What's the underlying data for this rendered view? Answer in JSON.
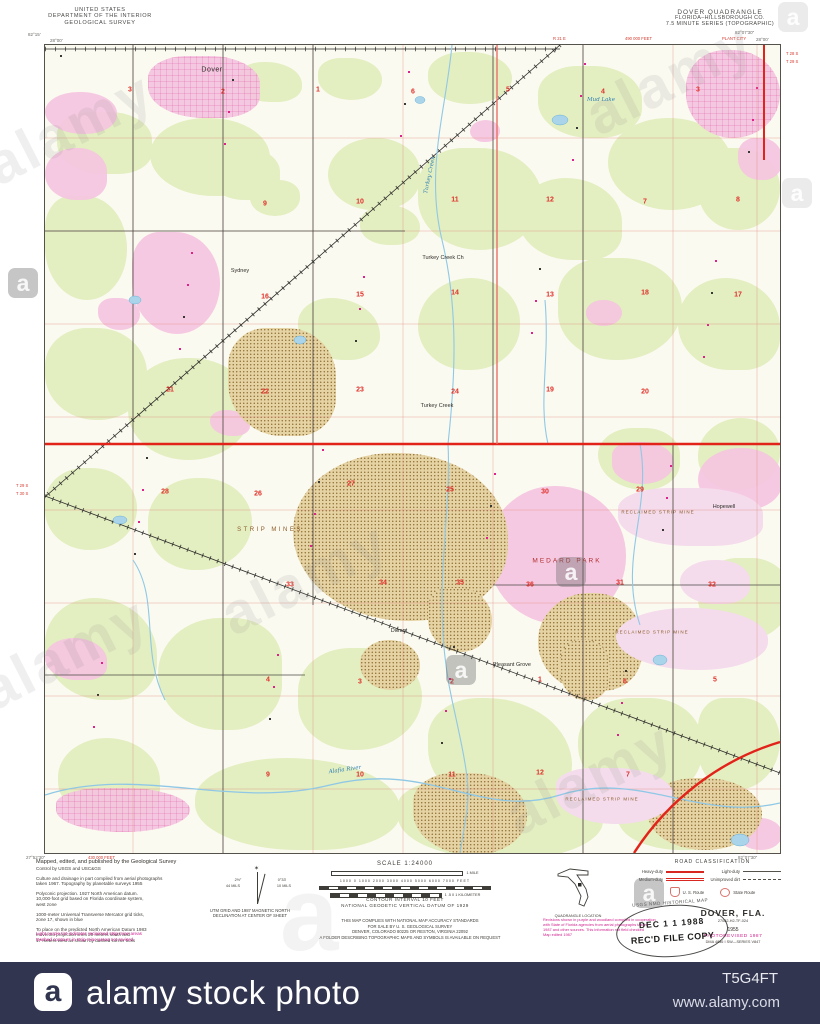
{
  "watermark": {
    "brand": "alamy",
    "letter": "a"
  },
  "footer_bar": {
    "logo_letter": "a",
    "brand": "alamy stock photo",
    "image_id": "T5G4FT",
    "url": "www.alamy.com"
  },
  "header": {
    "left": [
      "UNITED STATES",
      "DEPARTMENT OF THE INTERIOR",
      "GEOLOGICAL SURVEY"
    ],
    "right": [
      "DOVER QUADRANGLE",
      "FLORIDA–HILLSBOROUGH CO.",
      "7.5 MINUTE SERIES (TOPOGRAPHIC)"
    ]
  },
  "map": {
    "corners": {
      "tl_lon": "82°15'",
      "tl_lat": "28°00'",
      "tr_lon": "82°07'30\"",
      "tr_lat": "28°00'",
      "bl_lat": "27°52'30\"",
      "br_lon": "82°07'30\""
    },
    "margin_red": {
      "right_top": [
        "T 28 S",
        "T 29 S"
      ],
      "left_mid": [
        "T 29 S",
        "T 30 S"
      ],
      "feet_top": "490 000 FEET",
      "feet_bottom": "430 000 FEET",
      "range": "R 21 E",
      "city": "PLANT CITY"
    },
    "colors": {
      "woodland": "#e3eec1",
      "urban": "#f5c3e0",
      "mine": "#d9bc82",
      "reclaimed": "#f4dcec",
      "water": "#8fc8e6",
      "road_red": "#e2231a",
      "grid_red": "#dd8a7e",
      "number_red": "#e0302a",
      "magenta": "#cf1f8f"
    },
    "section_numbers": [
      {
        "n": "33",
        "x": 77,
        "y": -8
      },
      {
        "n": "32",
        "x": 162,
        "y": -8
      },
      {
        "n": "33",
        "x": 262,
        "y": -8
      },
      {
        "n": "31",
        "x": 592,
        "y": -8
      },
      {
        "n": "32",
        "x": 690,
        "y": -8
      },
      {
        "n": "3",
        "x": 85,
        "y": 45
      },
      {
        "n": "2",
        "x": 178,
        "y": 47
      },
      {
        "n": "1",
        "x": 273,
        "y": 45
      },
      {
        "n": "6",
        "x": 368,
        "y": 47
      },
      {
        "n": "5",
        "x": 463,
        "y": 45
      },
      {
        "n": "4",
        "x": 558,
        "y": 47
      },
      {
        "n": "3",
        "x": 653,
        "y": 45
      },
      {
        "n": "9",
        "x": 220,
        "y": 159
      },
      {
        "n": "10",
        "x": 315,
        "y": 157
      },
      {
        "n": "11",
        "x": 410,
        "y": 155
      },
      {
        "n": "12",
        "x": 505,
        "y": 155
      },
      {
        "n": "7",
        "x": 600,
        "y": 157
      },
      {
        "n": "8",
        "x": 693,
        "y": 155
      },
      {
        "n": "16",
        "x": 220,
        "y": 252
      },
      {
        "n": "15",
        "x": 315,
        "y": 250
      },
      {
        "n": "14",
        "x": 410,
        "y": 248
      },
      {
        "n": "13",
        "x": 505,
        "y": 250
      },
      {
        "n": "18",
        "x": 600,
        "y": 248
      },
      {
        "n": "17",
        "x": 693,
        "y": 250
      },
      {
        "n": "21",
        "x": 125,
        "y": 345
      },
      {
        "n": "22",
        "x": 220,
        "y": 347
      },
      {
        "n": "23",
        "x": 315,
        "y": 345
      },
      {
        "n": "24",
        "x": 410,
        "y": 347
      },
      {
        "n": "19",
        "x": 505,
        "y": 345
      },
      {
        "n": "20",
        "x": 600,
        "y": 347
      },
      {
        "n": "28",
        "x": 120,
        "y": 447
      },
      {
        "n": "26",
        "x": 213,
        "y": 449
      },
      {
        "n": "27",
        "x": 306,
        "y": 439
      },
      {
        "n": "25",
        "x": 405,
        "y": 445
      },
      {
        "n": "30",
        "x": 500,
        "y": 447
      },
      {
        "n": "29",
        "x": 595,
        "y": 445
      },
      {
        "n": "33",
        "x": 245,
        "y": 540
      },
      {
        "n": "34",
        "x": 338,
        "y": 538
      },
      {
        "n": "35",
        "x": 415,
        "y": 538
      },
      {
        "n": "36",
        "x": 485,
        "y": 540
      },
      {
        "n": "31",
        "x": 575,
        "y": 538
      },
      {
        "n": "32",
        "x": 667,
        "y": 540
      },
      {
        "n": "4",
        "x": 223,
        "y": 635
      },
      {
        "n": "3",
        "x": 315,
        "y": 637
      },
      {
        "n": "2",
        "x": 407,
        "y": 637
      },
      {
        "n": "1",
        "x": 495,
        "y": 635
      },
      {
        "n": "6",
        "x": 580,
        "y": 637
      },
      {
        "n": "5",
        "x": 670,
        "y": 635
      },
      {
        "n": "9",
        "x": 223,
        "y": 730
      },
      {
        "n": "10",
        "x": 315,
        "y": 730
      },
      {
        "n": "11",
        "x": 407,
        "y": 730
      },
      {
        "n": "12",
        "x": 495,
        "y": 728
      },
      {
        "n": "7",
        "x": 583,
        "y": 730
      }
    ],
    "labels": [
      {
        "t": "Dover",
        "x": 167,
        "y": 25,
        "c": "town"
      },
      {
        "t": "Sydney",
        "x": 195,
        "y": 226,
        "c": "hamlet"
      },
      {
        "t": "Turkey Creek",
        "x": 392,
        "y": 361,
        "c": "hamlet"
      },
      {
        "t": "Durant",
        "x": 354,
        "y": 586,
        "c": "hamlet"
      },
      {
        "t": "Pleasant Grove",
        "x": 467,
        "y": 620,
        "c": "hamlet"
      },
      {
        "t": "Hopewell",
        "x": 679,
        "y": 462,
        "c": "hamlet"
      },
      {
        "t": "Mud Lake",
        "x": 556,
        "y": 55,
        "c": "water"
      },
      {
        "t": "STRIP  MINES",
        "x": 225,
        "y": 485,
        "c": "mine-lbl"
      },
      {
        "t": "MEDARD  PARK",
        "x": 522,
        "y": 516,
        "c": "park"
      },
      {
        "t": "RECLAIMED STRIP MINE",
        "x": 613,
        "y": 467,
        "c": "mine-sm"
      },
      {
        "t": "RECLAIMED STRIP MINE",
        "x": 607,
        "y": 587,
        "c": "mine-sm"
      },
      {
        "t": "RECLAIMED STRIP MINE",
        "x": 557,
        "y": 754,
        "c": "mine-sm"
      },
      {
        "t": "Alafia River",
        "x": 300,
        "y": 725,
        "c": "water",
        "r": -8
      },
      {
        "t": "Turkey Creek",
        "x": 385,
        "y": 130,
        "c": "water",
        "r": -78
      },
      {
        "t": "Turkey Creek Ch",
        "x": 398,
        "y": 213,
        "c": "hamlet"
      }
    ]
  },
  "footer": {
    "credits": [
      "Mapped, edited, and published by the Geological Survey",
      "Control by USGS and USC&GS",
      "Culture and drainage in part compiled from aerial photographs",
      "taken 1967.  Topography by planetable surveys 1955",
      "Polyconic projection.  1927 North American datum.",
      "10,000-foot grid based on Florida coordinate system,",
      "west zone",
      "1000-meter Universal Transverse Mercator grid ticks,",
      "zone 17, shown in blue",
      "To place on the predicted North American Datum 1983",
      "move the projection lines 29 meters south and",
      "17 meters west as shown by dashed corner ticks"
    ],
    "purple_notes": [
      "Light purple tint indicates reclaimed strip mine areas",
      "Dashed contours in strip mine areas not revised"
    ],
    "declination": {
      "l1": "UTM GRID AND 1987 MAGNETIC NORTH",
      "l2": "DECLINATION AT CENTER OF SHEET",
      "left_top": "2½°",
      "left_bot": "44 MILS",
      "right_top": "0°33'",
      "right_bot": "10 MILS"
    },
    "scale": {
      "title": "SCALE 1:24000",
      "mile": "1 MILE",
      "feet": "1000    0    1000   2000   3000   4000   5000   6000   7000 FEET",
      "km": "1    .5    0    1 KILOMETER"
    },
    "contour": [
      "CONTOUR INTERVAL 10 FEET",
      "NATIONAL GEODETIC VERTICAL DATUM OF 1929"
    ],
    "sale": [
      "THIS MAP COMPLIES WITH NATIONAL MAP ACCURACY STANDARDS",
      "FOR SALE BY U. S. GEOLOGICAL SURVEY",
      "DENVER, COLORADO 80225 OR RESTON, VIRGINIA 22092",
      "A FOLDER DESCRIBING TOPOGRAPHIC MAPS AND SYMBOLS IS AVAILABLE ON REQUEST"
    ],
    "quad_location": "QUADRANGLE LOCATION",
    "road_class": {
      "title": "ROAD CLASSIFICATION",
      "col1": [
        {
          "label": "Heavy-duty"
        },
        {
          "label": "Medium-duty"
        }
      ],
      "col2": [
        {
          "label": "Light-duty"
        },
        {
          "label": "Unimproved dirt"
        }
      ],
      "us": "U. S. Route",
      "state": "State Route"
    },
    "revision_note": [
      "Revisions shown in purple and woodland compiled in cooperation",
      "with State of Florida agencies from aerial photographs taken",
      "1987 and other sources.  This information not field checked",
      "Map edited 1987"
    ],
    "title_block": {
      "name": "DOVER, FLA.",
      "code": "27082-H2-TF-024",
      "year": "1955",
      "rev": "PHOTOREVISED 1987",
      "series": "DMA 4836 I SW—SERIES V847"
    },
    "stamps": {
      "arc": "USGS NMD HISTORICAL MAP",
      "date": "DEC 1 1 1988",
      "copy": "REC'D FILE COPY"
    }
  }
}
